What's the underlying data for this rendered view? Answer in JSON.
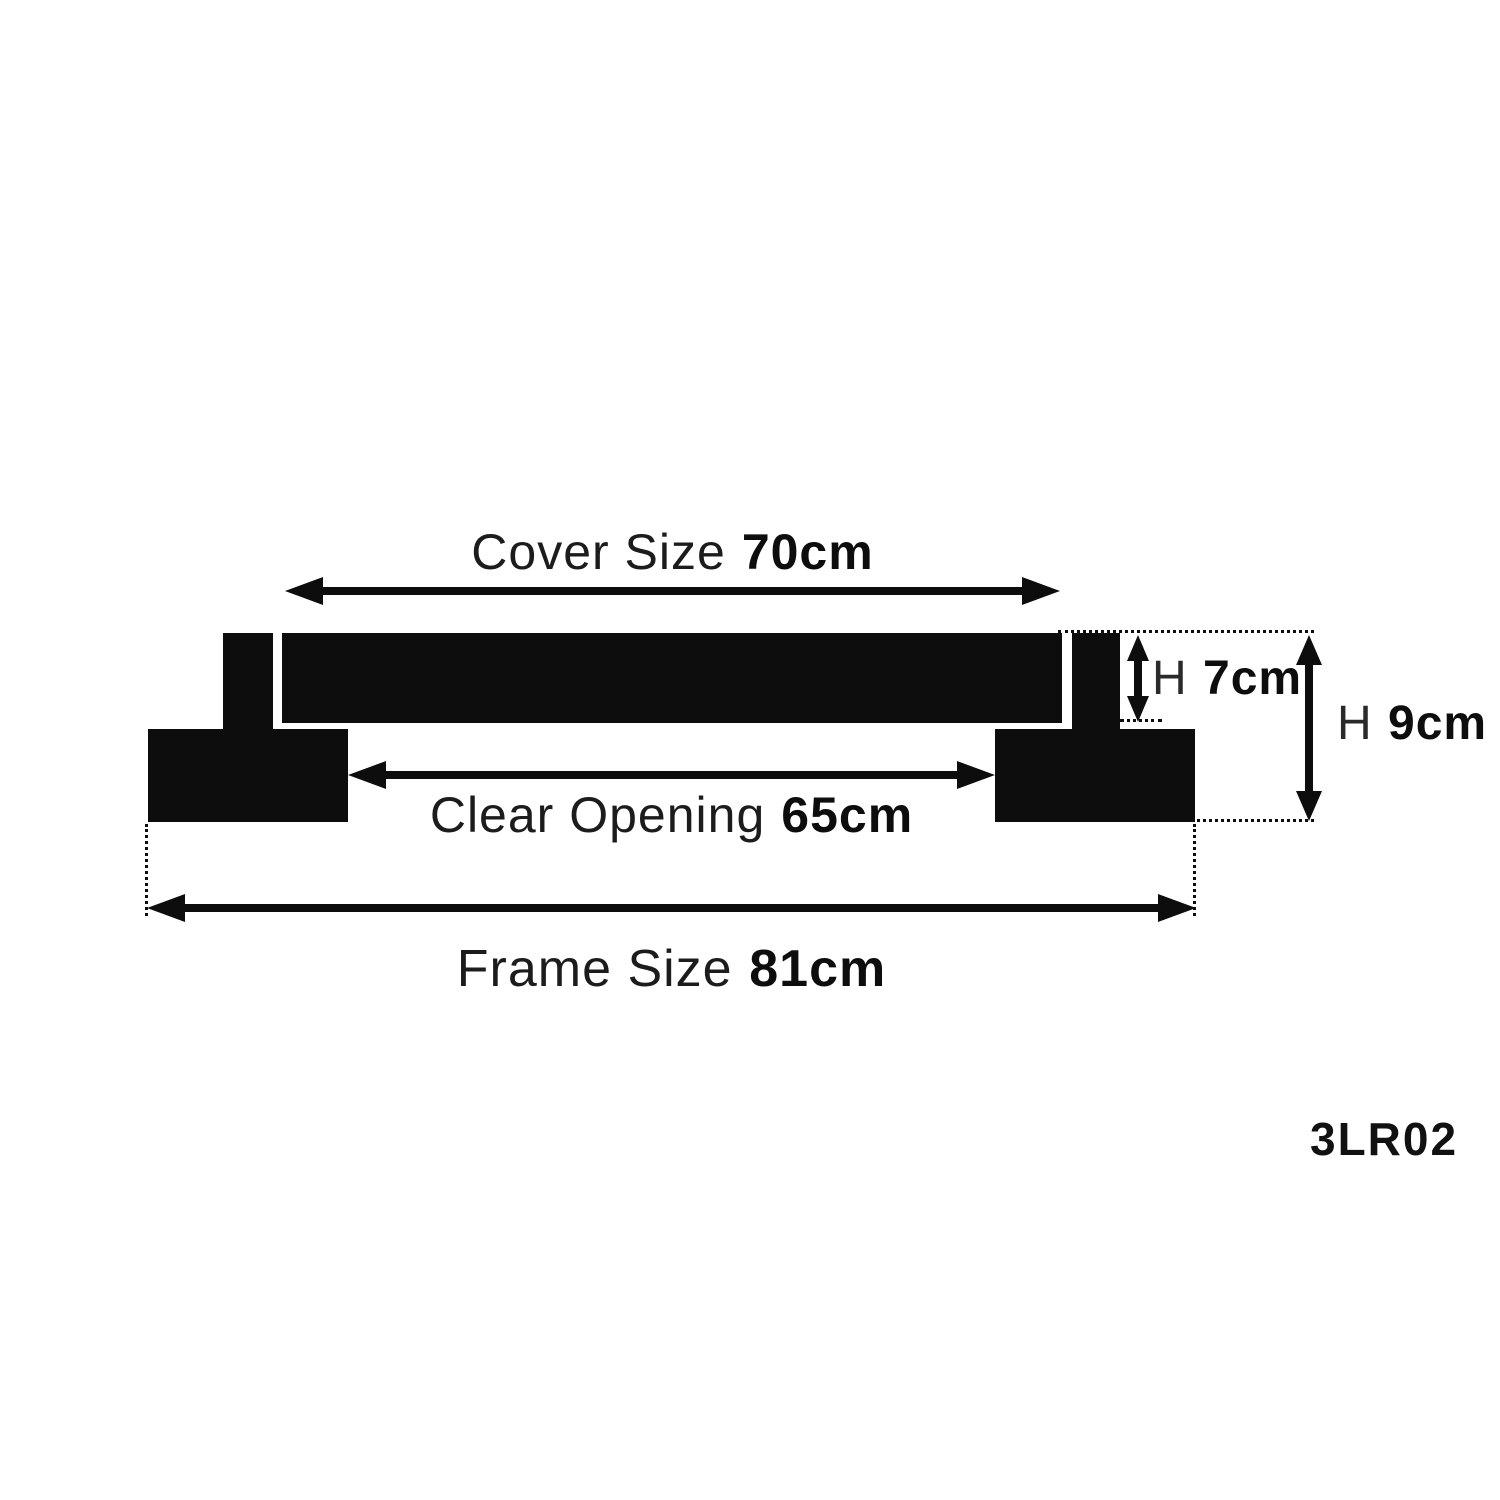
{
  "product_code": "3LR02",
  "dimensions": {
    "cover": {
      "label": "Cover Size",
      "value": "70cm"
    },
    "clear_opening": {
      "label": "Clear Opening",
      "value": "65cm"
    },
    "frame": {
      "label": "Frame Size",
      "value": "81cm"
    },
    "cover_height": {
      "label": "H",
      "value": "7cm"
    },
    "overall_height": {
      "label": "H",
      "value": "9cm"
    }
  },
  "colors": {
    "ink": "#0d0d0d",
    "background": "#ffffff"
  }
}
